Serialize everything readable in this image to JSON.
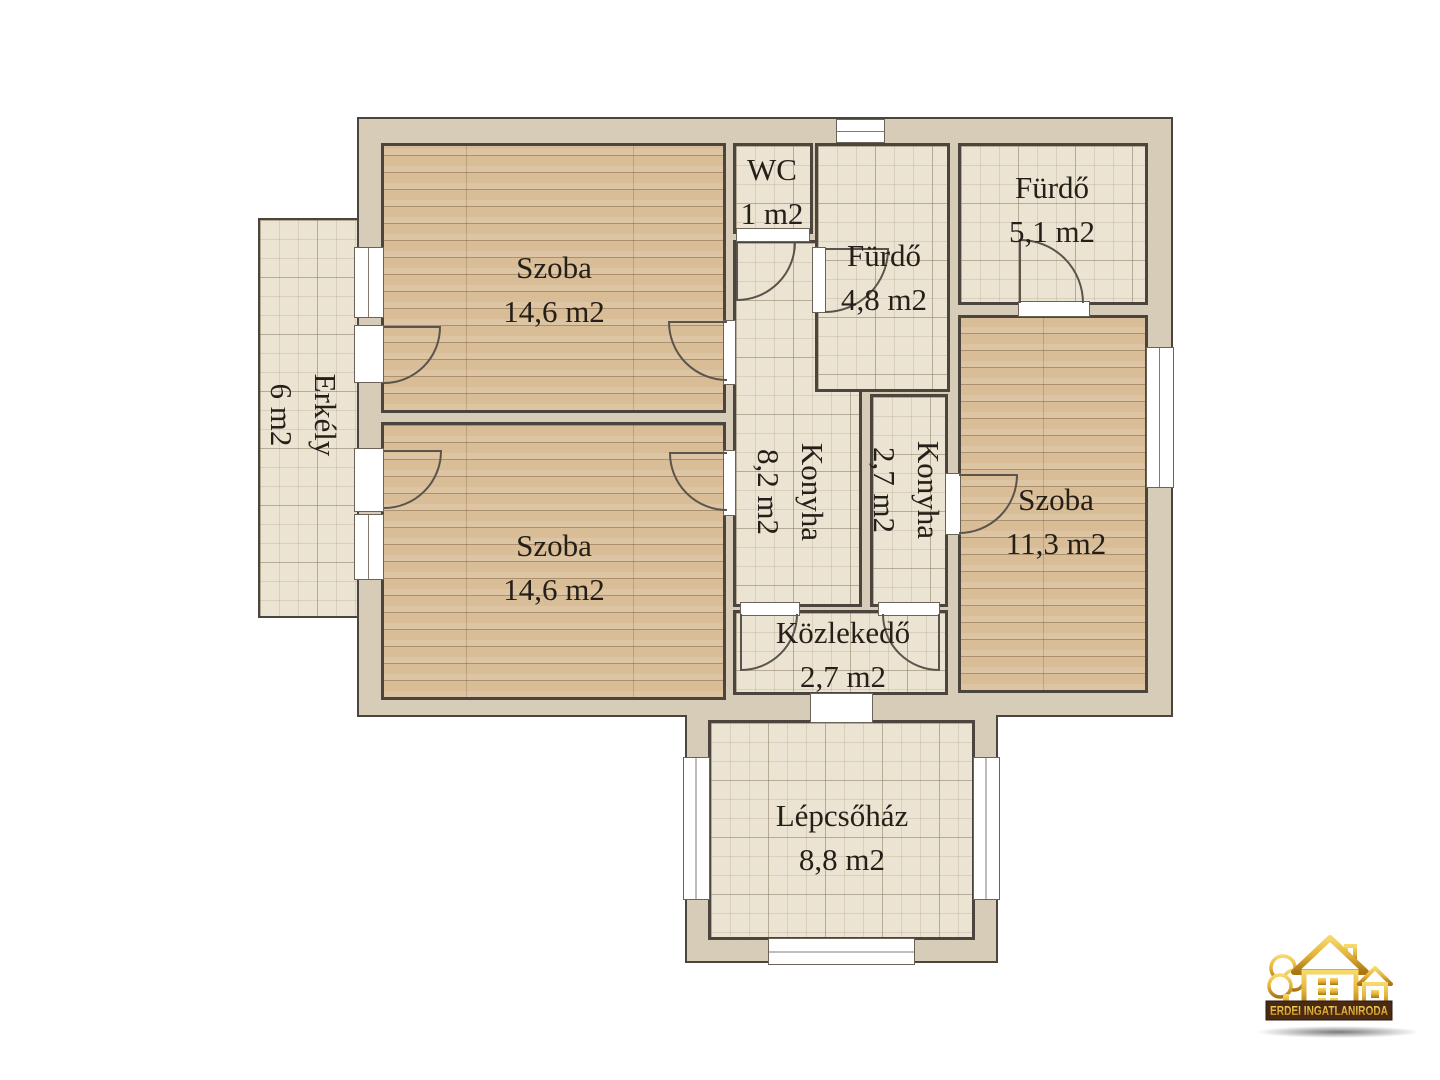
{
  "plan": {
    "title": "Alaprajz (floor plan)",
    "rooms": [
      {
        "id": "szoba-1",
        "label": "Szoba",
        "area": "14,6 m2"
      },
      {
        "id": "szoba-2",
        "label": "Szoba",
        "area": "14,6 m2"
      },
      {
        "id": "wc",
        "label": "WC",
        "area": "1 m2"
      },
      {
        "id": "furdo-48",
        "label": "Fürdő",
        "area": "4,8 m2"
      },
      {
        "id": "furdo-51",
        "label": "Fürdő",
        "area": "5,1 m2"
      },
      {
        "id": "konyha-82",
        "label": "Konyha",
        "area": "8,2 m2"
      },
      {
        "id": "konyha-27",
        "label": "Konyha",
        "area": "2,7 m2"
      },
      {
        "id": "szoba-113",
        "label": "Szoba",
        "area": "11,3 m2"
      },
      {
        "id": "kozlekedo",
        "label": "Közlekedő",
        "area": "2,7 m2"
      },
      {
        "id": "erkely",
        "label": "Erkély",
        "area": "6 m2"
      },
      {
        "id": "lepcsohaz",
        "label": "Lépcsőház",
        "area": "8,8 m2"
      }
    ]
  },
  "logo": {
    "brand": "ERDEI INGATLANIRODA"
  },
  "colors": {
    "wall_fill": "#d7ccb8",
    "wall_line": "#4b453e",
    "tile_floor": "#ece4d2",
    "wood_floor": "#d9bd97",
    "logo_gold": "#d4a017",
    "logo_banner": "#4a2a12"
  }
}
